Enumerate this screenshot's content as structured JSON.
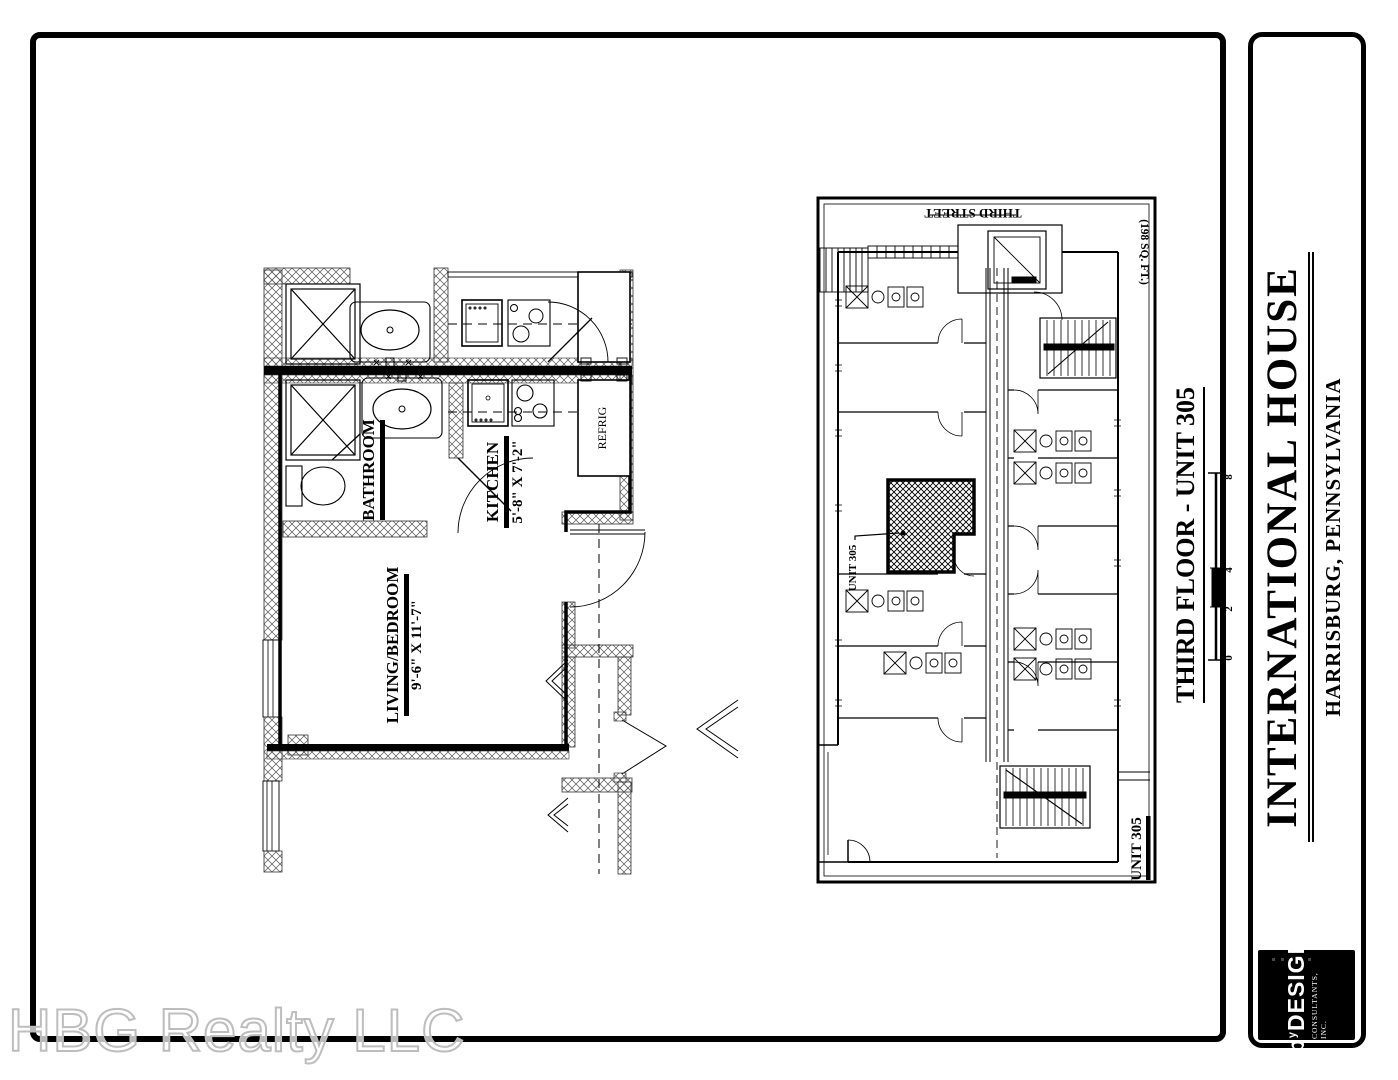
{
  "watermark": {
    "text": "HBG Realty LLC"
  },
  "title_block": {
    "title": "INTERNATIONAL HOUSE",
    "subtitle": "HARRISBURG, PENNSYLVANIA",
    "logo": {
      "prefix": "b",
      "sup": "y",
      "name": "DESIGN",
      "tagline": "CONSULTANTS, INC."
    }
  },
  "sheet": {
    "drawing_title": "THIRD FLOOR - UNIT 305",
    "scale_ticks": [
      "0",
      "2",
      "4",
      "8"
    ]
  },
  "overall_plan": {
    "street_label": "THIRD STREET",
    "area_label": "(198 SQ. FT.)",
    "unit_callout": "UNIT 305",
    "plan_title": "UNIT 305"
  },
  "unit_plan": {
    "bathroom_label": "BATHROOM",
    "kitchen_label": "KITCHEN",
    "kitchen_dim": "5'-8\" X 7'-2\"",
    "living_label": "LIVING/BEDROOM",
    "living_dim": "9'-6\" X 11'-7\"",
    "refrig_label": "REFRIG"
  },
  "colors": {
    "ink": "#000000",
    "paper": "#ffffff",
    "watermark_stroke": "#bdbdbd"
  }
}
